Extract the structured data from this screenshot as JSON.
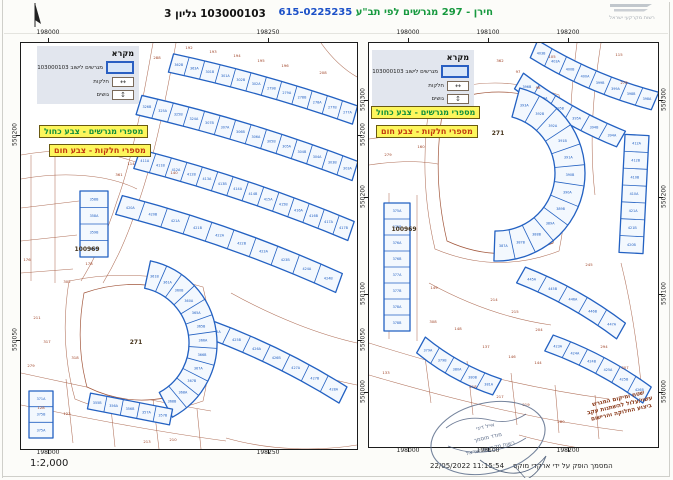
{
  "header": {
    "title_plan": "חירן - 297 מגרשים לפי תב\"ע",
    "title_number": "615-0225235",
    "sheet_label": "103000103 גליון 3",
    "logo_text": "רשות מקרקעי ישראל",
    "colors": {
      "title_green": "#17993f",
      "title_blue": "#1b50c8"
    }
  },
  "footer": {
    "scale": "1:2,000",
    "produced_by": "המסמך הופק על ידי ארקדי מוקס",
    "timestamp": "11:15:54 22/05/2022"
  },
  "legend": {
    "title": "מקרא",
    "items": [
      {
        "symbol": "lot-rect",
        "label": "מגרשים לישוב 103000103"
      },
      {
        "symbol": "parcel-rect",
        "label": "חלקות"
      },
      {
        "symbol": "block-arrows",
        "label": "גושים"
      }
    ],
    "notes": [
      {
        "text": "מספרי מגרשים - צבע כחול",
        "color": "#12903c"
      },
      {
        "text": "מספרי חלקות - צבע חום",
        "color": "#c23a10"
      }
    ]
  },
  "map_note": {
    "lines": [
      "שטח ומיקום המגרש",
      "עשוי/עלול להשתנות עקב",
      "ביצוע החלוקה והרישום"
    ]
  },
  "stamp": {
    "lines": [
      "אייל דיני",
      "מודד מוסמך",
      "רשות מקרקעי ישראל"
    ]
  },
  "map_colors": {
    "lot_blue": "#2361c2",
    "parcel_brown": "#a2573c",
    "number_brown": "#9c3d20",
    "block_dark": "#46341c"
  },
  "panels": [
    {
      "id": "panelL",
      "w": 336,
      "h": 406,
      "ticks": {
        "top": [
          {
            "label": "198000",
            "x": 28
          },
          {
            "label": "198250",
            "x": 248
          }
        ],
        "bottom": [
          {
            "label": "198000",
            "x": 28
          },
          {
            "label": "198250",
            "x": 248
          }
        ],
        "left": [
          {
            "label": "550200",
            "y": 93
          },
          {
            "label": "550050",
            "y": 298
          }
        ],
        "right": [
          {
            "label": "550200",
            "y": 93
          },
          {
            "label": "550050",
            "y": 298
          }
        ]
      },
      "roads": [
        "M132,0 C122,55 112,115 96,158 C84,196 72,218 60,238",
        "M155,0 C145,55 134,112 118,158 C106,196 94,220 82,240",
        "M0,112 C45,104 90,108 122,122",
        "M0,136 C45,128 88,132 116,146",
        "M10,112 L10,238",
        "M34,110 L34,240",
        "M0,165 L58,158",
        "M0,198 L56,192",
        "M0,230 L52,226",
        "M48,238 Q38,300 54,356 Q115,382 182,358 Q196,298 182,244 Q115,224 48,238 Z",
        "M0,330 C55,342 120,356 190,368",
        "M0,362 C60,374 130,388 205,398",
        "M45,336 L52,400",
        "M88,346 L94,404",
        "M132,356 L138,406",
        "M176,366 L180,406",
        "M210,250 C255,275 300,292 336,300",
        "M198,290 C250,318 300,335 336,342",
        "M205,395 C250,408 300,408 336,402",
        "M300,0 C310,14 322,26 336,34"
      ],
      "block": "M63,250 Q54,300 66,344 Q115,368 168,348 Q180,298 168,252 Q115,232 63,250 Z",
      "strips": [
        {
          "k": "l",
          "p": [
            150,
            20,
            334,
            72
          ],
          "w": 19,
          "b": -6,
          "lots": [
            "362B",
            "363A",
            "301B",
            "301A",
            "302B",
            "302A",
            "279B",
            "279A",
            "278B",
            "278A",
            "277B",
            "277A"
          ]
        },
        {
          "k": "l",
          "p": [
            118,
            62,
            334,
            128
          ],
          "w": 20,
          "b": -8,
          "lots": [
            "326B",
            "325A",
            "325B",
            "324A",
            "307B",
            "307A",
            "306B",
            "306A",
            "305B",
            "305A",
            "304B",
            "304A",
            "303B",
            "303A"
          ]
        },
        {
          "k": "l",
          "p": [
            116,
            116,
            330,
            188
          ],
          "w": 20,
          "b": -8,
          "lots": [
            "411A",
            "411B",
            "412A",
            "412B",
            "413A",
            "413B",
            "414A",
            "414B",
            "415A",
            "415B",
            "416A",
            "416B",
            "417A",
            "417B"
          ]
        },
        {
          "k": "l",
          "p": [
            98,
            162,
            318,
            240
          ],
          "w": 20,
          "b": -10,
          "lots": [
            "420A",
            "420B",
            "421A",
            "421B",
            "422A",
            "422B",
            "423A",
            "423B",
            "424A",
            "424B"
          ]
        },
        {
          "k": "l",
          "p": [
            185,
            285,
            322,
            352
          ],
          "w": 18,
          "b": -8,
          "lots": [
            "425A",
            "425B",
            "426A",
            "426B",
            "427A",
            "427B",
            "428A"
          ]
        },
        {
          "k": "f",
          "c": [
            112,
            300
          ],
          "r": [
            56,
            84
          ],
          "a": [
            -78,
            62
          ],
          "lots": [
            "361B",
            "361A",
            "360B",
            "360A",
            "365A",
            "365B",
            "366A",
            "366B",
            "367A",
            "367B",
            "368A",
            "368B"
          ]
        },
        {
          "k": "l",
          "p": [
            68,
            358,
            150,
            374
          ],
          "w": 16,
          "b": 0,
          "lots": [
            "355B",
            "356A",
            "356B",
            "357A",
            "357B"
          ]
        },
        {
          "k": "l",
          "p": [
            73,
            148,
            73,
            214
          ],
          "w": 28,
          "b": 0,
          "lots": [
            "358B",
            "358A",
            "359B",
            "359A"
          ]
        },
        {
          "k": "l",
          "p": [
            20,
            348,
            20,
            395
          ],
          "w": 24,
          "b": 0,
          "lots": [
            "371A",
            "375B",
            "375A"
          ]
        }
      ],
      "numbers": [
        [
          "192",
          168,
          6
        ],
        [
          "193",
          192,
          10
        ],
        [
          "194",
          216,
          14
        ],
        [
          "195",
          240,
          19
        ],
        [
          "196",
          264,
          24
        ],
        [
          "208",
          302,
          31
        ],
        [
          "288",
          136,
          16
        ],
        [
          "286",
          104,
          52
        ],
        [
          "176",
          6,
          218
        ],
        [
          "178",
          68,
          222
        ],
        [
          "211",
          16,
          276
        ],
        [
          "279",
          10,
          324
        ],
        [
          "302",
          46,
          240
        ],
        [
          "317",
          26,
          300
        ],
        [
          "318",
          54,
          316
        ],
        [
          "128",
          20,
          366
        ],
        [
          "123",
          46,
          372
        ],
        [
          "114",
          110,
          122
        ],
        [
          "140",
          153,
          131
        ],
        [
          "361",
          98,
          133
        ],
        [
          "213",
          126,
          400
        ],
        [
          "210",
          152,
          398
        ]
      ],
      "labels": [
        [
          "100969",
          66,
          208
        ],
        [
          "271",
          115,
          301
        ]
      ]
    },
    {
      "id": "panelR",
      "w": 289,
      "h": 404,
      "ticks": {
        "top": [
          {
            "label": "198000",
            "x": 40
          },
          {
            "label": "198100",
            "x": 120
          },
          {
            "label": "198200",
            "x": 200
          }
        ],
        "bottom": [
          {
            "label": "198000",
            "x": 40
          },
          {
            "label": "198100",
            "x": 120
          },
          {
            "label": "198200",
            "x": 200
          }
        ],
        "left": [
          {
            "label": "550300",
            "y": 58
          },
          {
            "label": "550200",
            "y": 155
          },
          {
            "label": "550100",
            "y": 252
          },
          {
            "label": "550000",
            "y": 350
          }
        ],
        "right": [
          {
            "label": "550300",
            "y": 58
          },
          {
            "label": "550200",
            "y": 155
          },
          {
            "label": "550100",
            "y": 252
          },
          {
            "label": "550000",
            "y": 350
          }
        ]
      },
      "roads": [
        "M62,52 Q48,130 66,206 Q128,232 190,208 Q206,128 190,52 Q126,28 62,52 Z",
        "M0,96 C40,90 70,92 96,102",
        "M0,122 C40,116 68,118 94,128",
        "M232,0 C224,50 220,100 226,152",
        "M208,0 C202,48 198,96 204,146",
        "M0,300 C70,322 150,344 240,356",
        "M0,332 C75,354 160,376 254,388",
        "M55,306 L62,360",
        "M98,318 L104,372",
        "M142,330 L148,382",
        "M186,342 L190,390",
        "M226,352 L230,396",
        "M150,392 C185,402 225,408 258,410",
        "M20,150 L20,296",
        "M48,152 L48,298",
        "M60,240 C100,262 140,276 182,282",
        "M252,220 C262,260 268,300 272,340"
      ],
      "block": "M75,60 Q62,130 78,198 Q130,222 184,200 Q198,128 184,60 Q130,38 75,60 Z",
      "strips": [
        {
          "k": "l",
          "p": [
            165,
            6,
            286,
            58
          ],
          "w": 19,
          "b": 10,
          "lots": [
            "403B",
            "403A",
            "400B",
            "400A",
            "399B",
            "399A",
            "398B",
            "398A"
          ]
        },
        {
          "k": "l",
          "p": [
            150,
            38,
            252,
            96
          ],
          "w": 18,
          "b": 8,
          "lots": [
            "396B",
            "396A",
            "395B",
            "395A",
            "394B",
            "394A"
          ]
        },
        {
          "k": "f",
          "c": [
            128,
            130
          ],
          "r": [
            58,
            88
          ],
          "a": [
            -75,
            92
          ],
          "lots": [
            "393A",
            "392B",
            "392A",
            "391B",
            "391A",
            "390B",
            "390A",
            "389B",
            "389A",
            "388B",
            "387B",
            "387A"
          ]
        },
        {
          "k": "l",
          "p": [
            268,
            92,
            262,
            210
          ],
          "w": 24,
          "b": 0,
          "lots": [
            "412A",
            "412B",
            "410B",
            "410A",
            "421A",
            "421B",
            "420B"
          ]
        },
        {
          "k": "l",
          "p": [
            152,
            232,
            252,
            288
          ],
          "w": 18,
          "b": -8,
          "lots": [
            "445A",
            "445B",
            "446A",
            "446B",
            "447A"
          ]
        },
        {
          "k": "l",
          "p": [
            180,
            300,
            278,
            352
          ],
          "w": 18,
          "b": -8,
          "lots": [
            "423A",
            "424A",
            "424B",
            "425A",
            "425B",
            "426B"
          ]
        },
        {
          "k": "l",
          "p": [
            28,
            160,
            28,
            288
          ],
          "w": 26,
          "b": 0,
          "lots": [
            "375A",
            "375B",
            "376A",
            "376B",
            "377A",
            "377B",
            "378A",
            "378B"
          ]
        },
        {
          "k": "l",
          "p": [
            52,
            302,
            128,
            344
          ],
          "w": 18,
          "b": 8,
          "lots": [
            "379A",
            "379B",
            "380A",
            "380B",
            "381A"
          ]
        }
      ],
      "numbers": [
        [
          "362",
          131,
          19
        ],
        [
          "97",
          149,
          30
        ],
        [
          "96",
          169,
          46
        ],
        [
          "105",
          183,
          15
        ],
        [
          "115",
          250,
          13
        ],
        [
          "278",
          255,
          41
        ],
        [
          "279",
          19,
          113
        ],
        [
          "160",
          52,
          105
        ],
        [
          "149",
          65,
          246
        ],
        [
          "308",
          64,
          280
        ],
        [
          "133",
          17,
          331
        ],
        [
          "214",
          125,
          258
        ],
        [
          "215",
          146,
          270
        ],
        [
          "148",
          89,
          287
        ],
        [
          "137",
          117,
          305
        ],
        [
          "146",
          143,
          315
        ],
        [
          "144",
          169,
          321
        ],
        [
          "218",
          104,
          345
        ],
        [
          "217",
          131,
          355
        ],
        [
          "219",
          157,
          363
        ],
        [
          "280",
          192,
          380
        ],
        [
          "294",
          235,
          305
        ],
        [
          "307",
          256,
          326
        ],
        [
          "245",
          220,
          223
        ],
        [
          "204",
          170,
          288
        ]
      ],
      "labels": [
        [
          "100969",
          35,
          188
        ],
        [
          "271",
          129,
          92
        ]
      ]
    }
  ]
}
